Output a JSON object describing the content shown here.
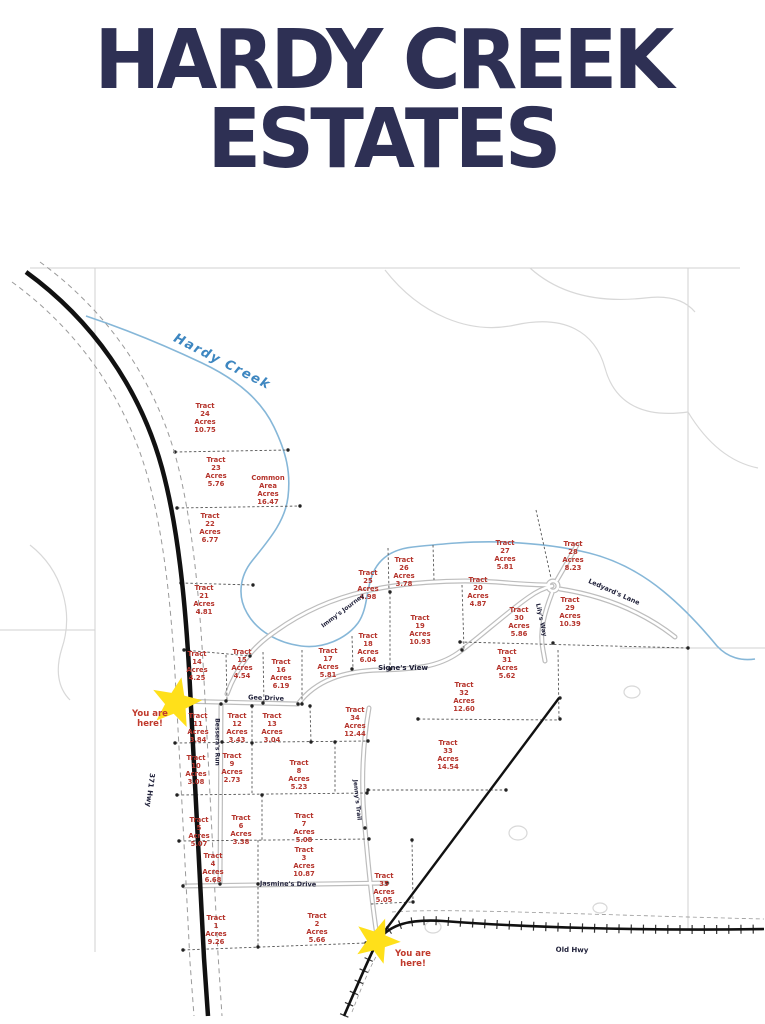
{
  "title": {
    "line1": "HARDY CREEK",
    "line2": "ESTATES"
  },
  "labels": {
    "acres_word": "Acres",
    "you_are_here": "You are here!",
    "creek": "Hardy Creek"
  },
  "map": {
    "tracts": [
      {
        "name": "Tract 1",
        "acres": "9.26",
        "x": 216,
        "y": 930
      },
      {
        "name": "Tract 2",
        "acres": "5.66",
        "x": 317,
        "y": 928
      },
      {
        "name": "Tract 3",
        "acres": "10.87",
        "x": 304,
        "y": 862
      },
      {
        "name": "Tract 4",
        "acres": "6.68",
        "x": 213,
        "y": 868
      },
      {
        "name": "Tract 5",
        "acres": "5.07",
        "x": 199,
        "y": 832
      },
      {
        "name": "Tract 6",
        "acres": "3.38",
        "x": 241,
        "y": 830
      },
      {
        "name": "Tract 7",
        "acres": "5.08",
        "x": 304,
        "y": 828
      },
      {
        "name": "Tract 8",
        "acres": "5.23",
        "x": 299,
        "y": 775
      },
      {
        "name": "Tract 9",
        "acres": "2.73",
        "x": 232,
        "y": 768
      },
      {
        "name": "Tract 10",
        "acres": "3.08",
        "x": 196,
        "y": 770
      },
      {
        "name": "Tract 11",
        "acres": "3.84",
        "x": 198,
        "y": 728
      },
      {
        "name": "Tract 12",
        "acres": "3.43",
        "x": 237,
        "y": 728
      },
      {
        "name": "Tract 13",
        "acres": "3.04",
        "x": 272,
        "y": 728
      },
      {
        "name": "Tract 14",
        "acres": "4.25",
        "x": 197,
        "y": 666
      },
      {
        "name": "Tract 15",
        "acres": "4.54",
        "x": 242,
        "y": 664
      },
      {
        "name": "Tract 16",
        "acres": "6.19",
        "x": 281,
        "y": 674
      },
      {
        "name": "Tract 17",
        "acres": "5.81",
        "x": 328,
        "y": 663
      },
      {
        "name": "Tract 18",
        "acres": "6.04",
        "x": 368,
        "y": 648
      },
      {
        "name": "Tract 19",
        "acres": "10.93",
        "x": 420,
        "y": 630
      },
      {
        "name": "Tract 20",
        "acres": "4.87",
        "x": 478,
        "y": 592
      },
      {
        "name": "Tract 21",
        "acres": "4.81",
        "x": 204,
        "y": 600
      },
      {
        "name": "Tract 22",
        "acres": "6.77",
        "x": 210,
        "y": 528
      },
      {
        "name": "Tract 23",
        "acres": "5.76",
        "x": 216,
        "y": 472
      },
      {
        "name": "Tract 24",
        "acres": "10.75",
        "x": 205,
        "y": 418
      },
      {
        "name": "Tract 25",
        "acres": "4.98",
        "x": 368,
        "y": 585
      },
      {
        "name": "Tract 26",
        "acres": "3.78",
        "x": 404,
        "y": 572
      },
      {
        "name": "Tract 27",
        "acres": "5.81",
        "x": 505,
        "y": 555
      },
      {
        "name": "Tract 28",
        "acres": "8.23",
        "x": 573,
        "y": 556
      },
      {
        "name": "Tract 29",
        "acres": "10.39",
        "x": 570,
        "y": 612
      },
      {
        "name": "Tract 30",
        "acres": "5.86",
        "x": 519,
        "y": 622
      },
      {
        "name": "Tract 31",
        "acres": "5.62",
        "x": 507,
        "y": 664
      },
      {
        "name": "Tract 32",
        "acres": "12.60",
        "x": 464,
        "y": 697
      },
      {
        "name": "Tract 33",
        "acres": "14.54",
        "x": 448,
        "y": 755
      },
      {
        "name": "Tract 34",
        "acres": "12.44",
        "x": 355,
        "y": 722
      },
      {
        "name": "Tract 35",
        "acres": "5.05",
        "x": 384,
        "y": 888
      },
      {
        "name": "Common Area",
        "acres": "16.47",
        "x": 268,
        "y": 490
      }
    ],
    "roads": [
      {
        "name": "371 Hwy",
        "x": 150,
        "y": 790,
        "rot": 97,
        "size": 7
      },
      {
        "name": "Old Hwy",
        "x": 572,
        "y": 950,
        "rot": 1,
        "size": 7
      },
      {
        "name": "Gee Drive",
        "x": 266,
        "y": 698,
        "rot": 2,
        "size": 6.5
      },
      {
        "name": "Bessera's Run",
        "x": 217,
        "y": 742,
        "rot": 90,
        "size": 6
      },
      {
        "name": "Jenny's Trail",
        "x": 357,
        "y": 800,
        "rot": 84,
        "size": 6
      },
      {
        "name": "Jasmine's Drive",
        "x": 288,
        "y": 884,
        "rot": 1,
        "size": 6.5
      },
      {
        "name": "Signe's View",
        "x": 403,
        "y": 668,
        "rot": 0,
        "size": 7
      },
      {
        "name": "Immy's Journey",
        "x": 343,
        "y": 611,
        "rot": -37,
        "size": 6
      },
      {
        "name": "Ledyard's Lane",
        "x": 614,
        "y": 592,
        "rot": 24,
        "size": 6.5
      },
      {
        "name": "Lily's Way",
        "x": 541,
        "y": 620,
        "rot": 78,
        "size": 6
      }
    ],
    "you_are_here_points": [
      {
        "x": 150,
        "y": 720
      },
      {
        "x": 413,
        "y": 960
      }
    ]
  },
  "colors": {
    "title": "#2e3054",
    "tract_label": "#b5342c",
    "creek": "#86b7d8",
    "creek_label": "#3d86c0",
    "road_label": "#20213a",
    "star": "#ffe01a"
  }
}
